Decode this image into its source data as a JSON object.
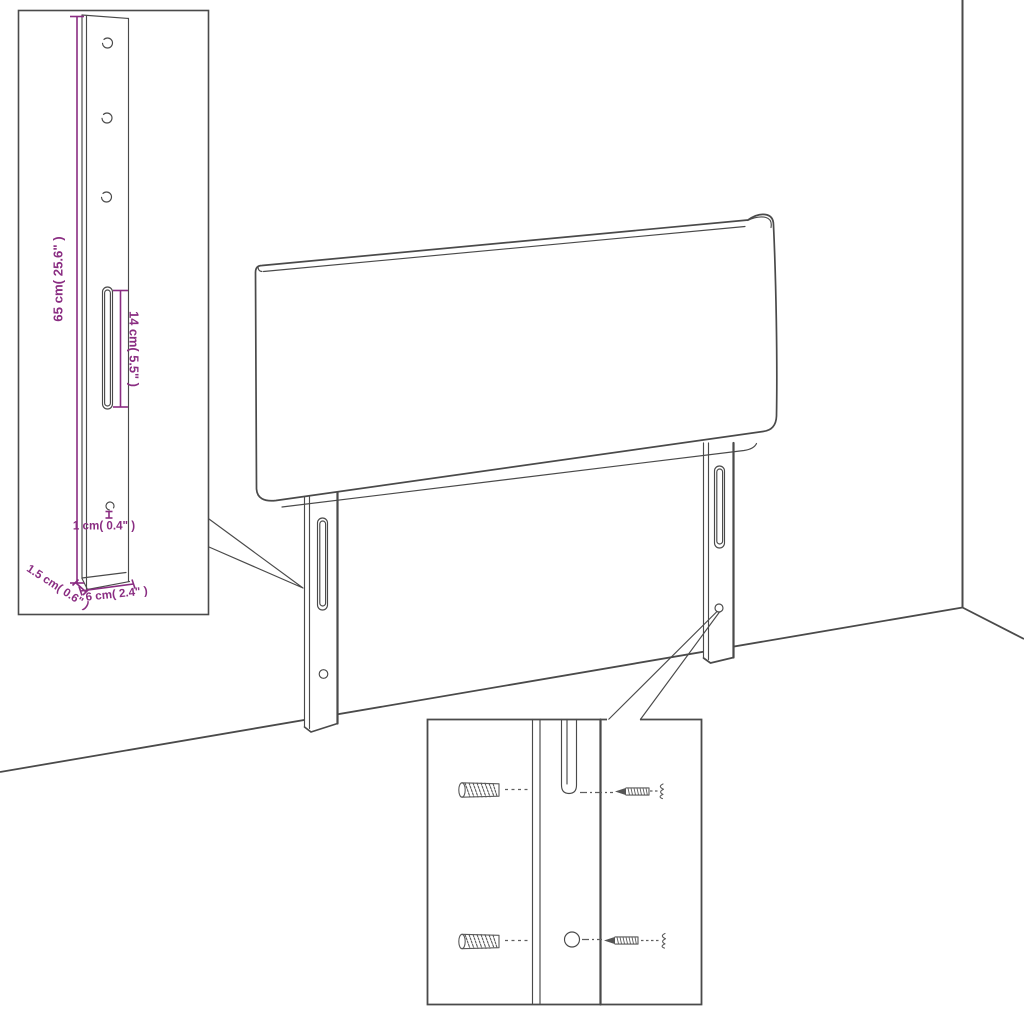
{
  "diagram": {
    "kind": "furniture-assembly-dimension-diagram",
    "subject": "upholstered headboard with two adjustable mounting legs shown in a room corner",
    "colors": {
      "background": "#ffffff",
      "line": "#4a4a4a",
      "dimension": "#8a2d82"
    },
    "labels": {
      "bracket_height": "65 cm( 25.6\" )",
      "slot_length": "14 cm( 5.5\" )",
      "hole_diameter": "1 cm( 0.4\" )",
      "bracket_thickness": "1.5 cm( 0.6\" )",
      "bracket_width": "6 cm( 2.4\" )"
    },
    "insets": {
      "bracket_detail": {
        "description": "enlarged mounting leg bracket with three holes, long slot and one small hole",
        "hole_count": 3
      },
      "hardware_detail": {
        "description": "leg strip with slot and hole, wall plugs on the left, screws on the right",
        "parts": [
          "wall-plug",
          "screw"
        ],
        "rows": 2
      }
    }
  }
}
